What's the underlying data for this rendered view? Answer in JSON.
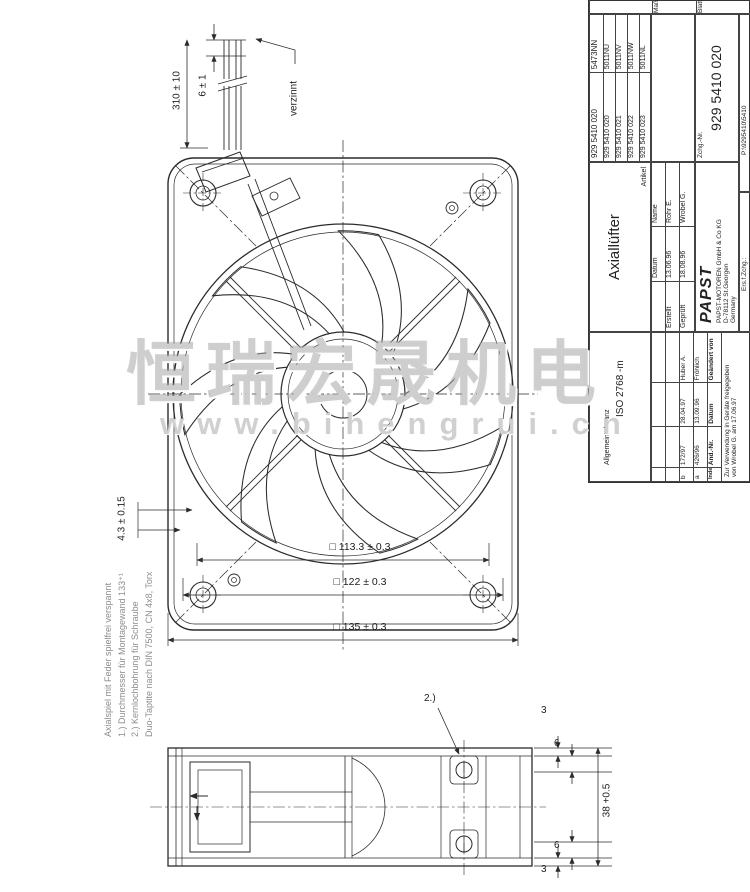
{
  "watermark": {
    "text_cn": "恒瑞宏晟机电",
    "text_url": "www.bihengrui.cn",
    "color": "#a8a8a8"
  },
  "front_view": {
    "wire_length_dim": "310 ± 10",
    "wire_tin_dim": "6 ± 1",
    "wire_finish": "verzinnt",
    "flange_thickness_dim": "4.3 ± 0.15",
    "square_dims": [
      "□ 113.3 ± 0.3",
      "□ 122 ± 0.3",
      "□ 135 ± 0.3"
    ]
  },
  "side_view": {
    "note_ref": "2.)",
    "dim_top_lip": "3",
    "dim_top_depth": "6",
    "dim_height": "38 +0.5",
    "dim_bottom_depth": "6",
    "dim_bottom_lip": "3"
  },
  "notes": {
    "lines": [
      "Axialspiel mit Feder spielfrei verspannt",
      "1.) Durchmesser für Montagewand 133⁺¹",
      "2.) Kernlochbohrung für Schraube",
      "Duo-Taptite nach DIN 7500, CN 4x8, Torx"
    ]
  },
  "title_block": {
    "scale_cell": "Maßstab",
    "sheet_cell": "Blatt",
    "variant_table": {
      "header_num": "929 5410 020",
      "header_code": "5473NN",
      "rows": [
        {
          "num": "929 5410 020",
          "code": "5011NU"
        },
        {
          "num": "929 5410 021",
          "code": "5011NV"
        },
        {
          "num": "929 5410 022",
          "code": "5011NW"
        },
        {
          "num": "929 5410 023",
          "code": "5011NL"
        }
      ]
    },
    "artikel_label": "Artikel",
    "artikel": "Axiallüfter",
    "zchg_label": "Zchg.-Nr.",
    "zchg_nr": "929 5410 020",
    "ers_label": "Ers.f.Zchg.:",
    "file_path": "P:\\9295410\\5410",
    "tolerance_label": "Allgemeintoleranz",
    "tolerance_value": "ISO 2768 -m",
    "company": {
      "logo": "PAPST",
      "address1": "PAPST-MOTOREN GmbH & Co KG",
      "address2": "D-78112 St.Georgen",
      "address3": "Germany"
    },
    "sign_table": {
      "col_datum": "Datum",
      "col_name": "Name",
      "rows": [
        {
          "label": "Erstellt",
          "date": "13.06.96",
          "name": "Rohr E."
        },
        {
          "label": "Geprüft",
          "date": "18.08.96",
          "name": "Wrobel G."
        }
      ]
    },
    "revision_table": {
      "headers": [
        "Index",
        "Änd.-Nr.",
        "Datum",
        "Geändert von"
      ],
      "rows": [
        {
          "index": "b",
          "nr": "172/97",
          "date": "28.04.97",
          "name": "Huber A."
        },
        {
          "index": "a",
          "nr": "426/96",
          "date": "13.09.96",
          "name": "Fröhlich"
        }
      ]
    },
    "release_note_line1": "Zur Verwendung in Geräte freigegeben",
    "release_note_line2": "von Wrobel G.   am 17.06.97"
  }
}
